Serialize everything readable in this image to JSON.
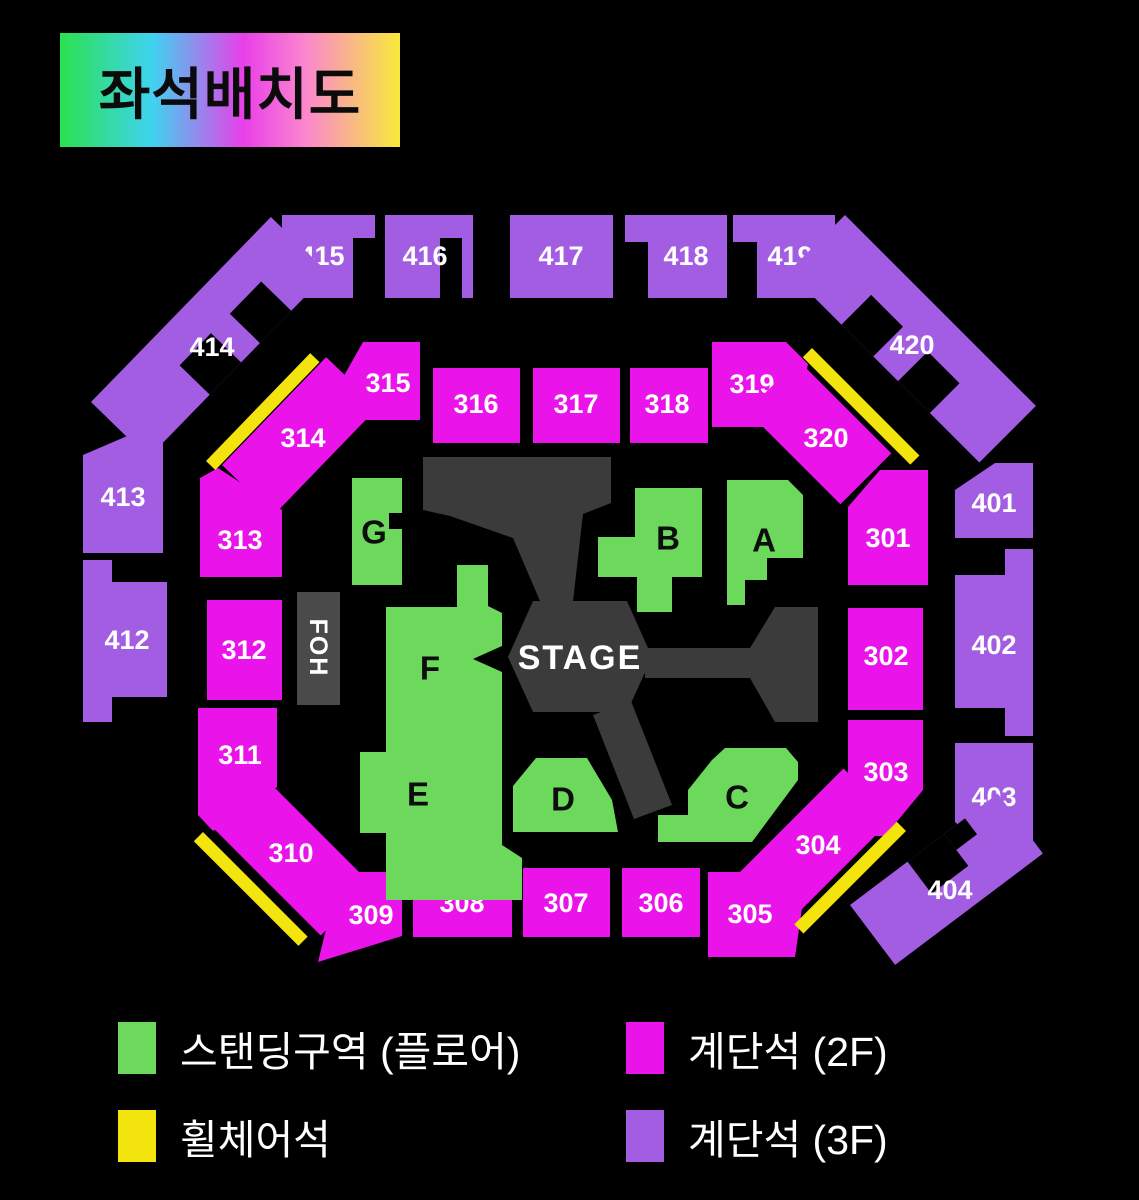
{
  "title": "좌석배치도",
  "colors": {
    "background": "#000000",
    "floor_standing": "#6cd95c",
    "tier_2f": "#ea14ea",
    "tier_3f": "#a35de3",
    "wheelchair": "#f2e40c",
    "stage": "#3b3b3b",
    "foh": "#4a4a4a",
    "label_text": "#ffffff",
    "floor_label_text": "#0d0d0d"
  },
  "map": {
    "stage_label": "STAGE",
    "foh_label": "FOH",
    "labels": {
      "s301": "301",
      "s302": "302",
      "s303": "303",
      "s304": "304",
      "s305": "305",
      "s306": "306",
      "s307": "307",
      "s308": "308",
      "s309": "309",
      "s310": "310",
      "s311": "311",
      "s312": "312",
      "s313": "313",
      "s314": "314",
      "s315": "315",
      "s316": "316",
      "s317": "317",
      "s318": "318",
      "s319": "319",
      "s320": "320",
      "s401": "401",
      "s402": "402",
      "s403": "403",
      "s404": "404",
      "s412": "412",
      "s413": "413",
      "s414": "414",
      "s415": "415",
      "s416": "416",
      "s417": "417",
      "s418": "418",
      "s419": "419",
      "s420": "420",
      "gA": "A",
      "gB": "B",
      "gC": "C",
      "gD": "D",
      "gE": "E",
      "gF": "F",
      "gG": "G"
    }
  },
  "legend": {
    "items": [
      {
        "name": "standing-floor",
        "label": "스탠딩구역 (플로어)",
        "color": "#6cd95c"
      },
      {
        "name": "tier-2f",
        "label": "계단석 (2F)",
        "color": "#ea14ea"
      },
      {
        "name": "wheelchair",
        "label": "휠체어석",
        "color": "#f2e40c"
      },
      {
        "name": "tier-3f",
        "label": "계단석 (3F)",
        "color": "#a35de3"
      }
    ]
  }
}
